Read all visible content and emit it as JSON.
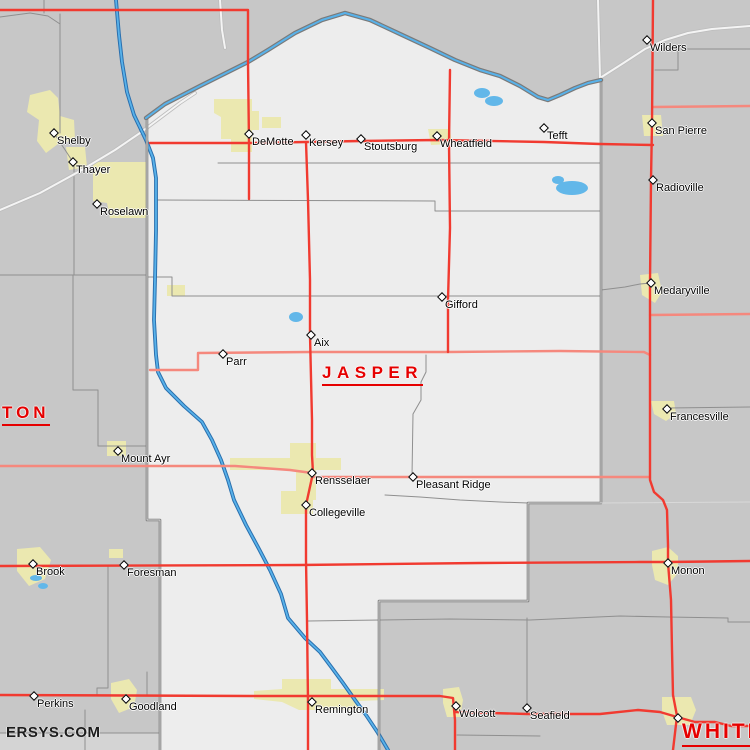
{
  "watermark": "ERSYS.COM",
  "colors": {
    "county_fill": "#ededed",
    "outside_fill": "#c7c7c7",
    "south_strip_fill": "#d4d4d4",
    "urban_fill": "#ebe8b0",
    "water": "#58b2ea",
    "water_edge": "#2a6fae",
    "major_road": "#f13a30",
    "secondary_road": "#f5887d",
    "white_road": "#f4f4f4",
    "boundary": "#787878",
    "civil_line": "#8f8f8f",
    "county_label": "#e60000",
    "town_label": "#000000"
  },
  "county_labels": [
    {
      "id": "jasper",
      "text": "JASPER",
      "x": 322,
      "y": 363,
      "font_px": 17,
      "letter_spacing_px": 5.5
    },
    {
      "id": "newton",
      "text": "TON",
      "x": 2,
      "y": 403,
      "font_px": 17,
      "letter_spacing_px": 4
    },
    {
      "id": "white",
      "text": "WHITE",
      "x": 682,
      "y": 720,
      "font_px": 21,
      "letter_spacing_px": 3
    }
  ],
  "towns": [
    {
      "name": "Shelby",
      "x": 54,
      "y": 133
    },
    {
      "name": "Thayer",
      "x": 73,
      "y": 162
    },
    {
      "name": "Roselawn",
      "x": 97,
      "y": 204
    },
    {
      "name": "DeMotte",
      "x": 249,
      "y": 134
    },
    {
      "name": "Kersey",
      "x": 306,
      "y": 135
    },
    {
      "name": "Stoutsburg",
      "x": 361,
      "y": 139
    },
    {
      "name": "Wheatfield",
      "x": 437,
      "y": 136
    },
    {
      "name": "Tefft",
      "x": 544,
      "y": 128
    },
    {
      "name": "Wilders",
      "x": 647,
      "y": 40
    },
    {
      "name": "San Pierre",
      "x": 652,
      "y": 123
    },
    {
      "name": "Radioville",
      "x": 653,
      "y": 180
    },
    {
      "name": "Medaryville",
      "x": 651,
      "y": 283
    },
    {
      "name": "Francesville",
      "x": 667,
      "y": 409
    },
    {
      "name": "Gifford",
      "x": 442,
      "y": 297
    },
    {
      "name": "Aix",
      "x": 311,
      "y": 335
    },
    {
      "name": "Parr",
      "x": 223,
      "y": 354
    },
    {
      "name": "Mount Ayr",
      "x": 118,
      "y": 451
    },
    {
      "name": "Rensselaer",
      "x": 312,
      "y": 473
    },
    {
      "name": "Pleasant Ridge",
      "x": 413,
      "y": 477
    },
    {
      "name": "Collegeville",
      "x": 306,
      "y": 505
    },
    {
      "name": "Brook",
      "x": 33,
      "y": 564
    },
    {
      "name": "Foresman",
      "x": 124,
      "y": 565
    },
    {
      "name": "Perkins",
      "x": 34,
      "y": 696
    },
    {
      "name": "Goodland",
      "x": 126,
      "y": 699
    },
    {
      "name": "Remington",
      "x": 312,
      "y": 702
    },
    {
      "name": "Wolcott",
      "x": 456,
      "y": 706
    },
    {
      "name": "Seafield",
      "x": 527,
      "y": 708
    },
    {
      "name": "Monon",
      "x": 668,
      "y": 563
    },
    {
      "name": "",
      "x": 678,
      "y": 718
    }
  ],
  "map": {
    "layers": [
      {
        "name": "south-county-region",
        "type": "fill",
        "color": "#d4d4d4",
        "paths": [
          "M0,733 L160,733 L160,750 L0,750 Z"
        ]
      },
      {
        "name": "jasper-county-region",
        "type": "fill",
        "color": "#ededed",
        "paths": [
          "M146,118 L165,104 L200,86 L232,70 L248,62 L268,50 L295,33 L322,20 L345,13 L370,20 L400,34 L430,48 L455,60 L480,70 L500,76 L520,86 L538,97 L548,100 L560,95 L575,88 L588,83 L601,80 L601,503 L528,503 L528,601 L379,601 L379,750 L160,750 L160,520 L147,520 Z"
        ]
      },
      {
        "name": "urban-areas",
        "type": "fill",
        "color": "#ebe8b0",
        "paths": [
          "M30,95 L50,90 L58,98 L60,116 L74,120 L75,140 L58,144 L46,153 L37,141 L39,120 L27,112 Z",
          "M66,147 L85,147 L87,167 L69,170 Z",
          "M93,162 L148,162 L148,218 L110,218 L107,203 L93,201 Z",
          "M214,99 L252,99 L252,111 L259,111 L259,130 L252,130 L252,152 L231,152 L231,139 L221,139 L221,117 L214,113 Z",
          "M262,117 L281,117 L281,128 L262,128 Z",
          "M428,129 L450,129 L452,144 L431,145 Z",
          "M642,115 L661,115 L663,136 L644,136 Z",
          "M640,275 L658,273 L662,292 L655,303 L642,295 Z",
          "M651,401 L674,401 L676,414 L666,421 L654,414 Z",
          "M107,441 L126,441 L126,456 L107,456 Z",
          "M230,458 L290,458 L290,443 L316,443 L316,458 L341,458 L341,470 L316,470 L316,500 L313,500 L313,514 L281,514 L281,491 L296,491 L296,470 L230,470 Z",
          "M17,549 L40,547 L51,560 L45,579 L29,586 L17,571 Z",
          "M109,549 L123,549 L123,558 L109,558 Z",
          "M111,683 L129,679 L137,690 L134,707 L119,713 L111,699 Z",
          "M254,691 L282,689 L282,679 L331,679 L331,689 L384,689 L384,700 L359,701 L359,710 L299,710 L282,702 L254,699 Z",
          "M443,689 L459,687 L463,700 L460,717 L447,717 L443,703 Z",
          "M652,551 L668,547 L678,556 L678,573 L668,585 L655,580 L652,565 Z",
          "M662,697 L691,697 L696,710 L690,725 L667,725 L662,711 Z",
          "M167,285 L185,285 L185,296 L167,296 Z"
        ]
      },
      {
        "name": "lakes",
        "type": "fill",
        "color": "#62b7e9",
        "paths": [
          "M556,188 a16,7 0 1 0 32,0 a16,7 0 1 0 -32,0 Z",
          "M552,180 a6,4 0 1 0 12,0 a6,4 0 1 0 -12,0 Z",
          "M474,93 a8,5 0 1 0 16,0 a8,5 0 1 0 -16,0 Z",
          "M485,101 a9,5 0 1 0 18,0 a9,5 0 1 0 -18,0 Z",
          "M289,317 a7,5 0 1 0 14,0 a7,5 0 1 0 -14,0 Z",
          "M30,578 a6,3 0 1 0 12,0 a6,3 0 1 0 -12,0 Z",
          "M38,586 a5,3 0 1 0 10,0 a5,3 0 1 0 -10,0 Z"
        ]
      },
      {
        "name": "civil-township-lines",
        "type": "stroke",
        "color": "#8f8f8f",
        "width": 1,
        "paths": [
          "M218,163 L601,163",
          "M156,200 L435,201 L435,211 L601,211",
          "M148,277 L172,277 L172,296 L601,296",
          "M0,275 L147,275",
          "M426,355 L426,372 L421,382 L421,400 L413,414 L412,476",
          "M385,495 L420,497 L460,500 L500,502 L528,503",
          "M308,621 L380,620 L450,619 L530,620 L575,618 L620,616 L668,617 L728,618 L728,622 L750,622",
          "M527,618 L527,706",
          "M108,566 L108,688 L97,688 L97,695",
          "M147,672 L147,695",
          "M85,710 L85,750",
          "M60,14 L60,133",
          "M0,17 L30,13 L48,16 L60,24",
          "M44,0 L44,13",
          "M54,133 L73,162",
          "M74,165 L74,275",
          "M73,275 L73,390 L98,390 L98,446 L147,446",
          "M601,290 L625,287 L640,284 L651,283",
          "M668,408 L750,407",
          "M655,49 L750,49",
          "M678,49 L678,70 L655,70",
          "M457,735 L540,736",
          "M0,733 L160,733"
        ]
      },
      {
        "name": "white-road-casing",
        "type": "stroke",
        "color": "#bcbcbc",
        "width": 3.6,
        "paths": [
          "M0,210 L40,193 L80,171 L115,150 L140,133 L160,118 L180,103 L195,93",
          "M598,0 L599,40 L600,78",
          "M600,78 L622,64 L645,49 L665,40 L688,33 L712,29 L750,26",
          "M220,0 L222,30 L225,48"
        ]
      },
      {
        "name": "white-road-core",
        "type": "stroke",
        "color": "#f4f4f4",
        "width": 2,
        "paths": [
          "M0,210 L40,193 L80,171 L115,150 L140,133 L160,118 L180,103 L195,93",
          "M598,0 L599,40 L600,78",
          "M600,78 L622,64 L645,49 L665,40 L688,33 L712,29 L750,26",
          "M220,0 L222,30 L225,48"
        ]
      },
      {
        "name": "river-casing",
        "type": "stroke",
        "color": "#2a6fae",
        "width": 3.8,
        "paths": [
          "M116,0 L119,35 L122,62 L127,92 L134,115 L146,140 L153,158 L156,178 L156,230 L155,280 L154,320 L156,355 L158,372 L166,388 L184,406 L202,422 L212,440 L221,460 L228,480 L234,500 L246,525 L259,549 L270,570 L281,594 L288,618 L305,638 L320,652 L332,668 L343,683 L355,700 L366,715 L378,733 L388,750"
        ]
      },
      {
        "name": "river-core",
        "type": "stroke",
        "color": "#58b2ea",
        "width": 1.8,
        "paths": [
          "M116,0 L119,35 L122,62 L127,92 L134,115 L146,140 L153,158 L156,178 L156,230 L155,280 L154,320 L156,355 L158,372 L166,388 L184,406 L202,422 L212,440 L221,460 L228,480 L234,500 L246,525 L259,549 L270,570 L281,594 L288,618 L305,638 L320,652 L332,668 L343,683 L355,700 L366,715 L378,733 L388,750"
        ]
      },
      {
        "name": "county-boundary",
        "type": "stroke",
        "color": "#787878",
        "width": 2.6,
        "paths": [
          "M147,118 L147,520 L160,520 L160,750",
          "M601,80 L601,503 L528,503 L528,601 L379,601 L379,750"
        ]
      },
      {
        "name": "county-boundary-core",
        "type": "stroke",
        "color": "#dcdcdc",
        "width": 0.9,
        "paths": [
          "M147,118 L147,520 L160,520 L160,750",
          "M601,80 L601,503 L528,503 L528,601 L379,601 L379,750"
        ]
      },
      {
        "name": "river-boundary-casing",
        "type": "stroke",
        "color": "#7a7a7a",
        "width": 4.4,
        "paths": [
          "M146,118 L165,104 L200,86 L232,70 L248,62 L268,50 L295,33 L322,20 L345,13 L370,20 L400,34 L430,48 L455,60 L480,70 L500,76 L520,86 L538,97 L548,100 L560,95 L575,88 L588,83 L601,80"
        ]
      },
      {
        "name": "river-boundary-core",
        "type": "stroke",
        "color": "#58b2ea",
        "width": 2,
        "paths": [
          "M146,118 L165,104 L200,86 L232,70 L248,62 L268,50 L295,33 L322,20 L345,13 L370,20 L400,34 L430,48 L455,60 L480,70 L500,76 L520,86 L538,97 L548,100 L560,95 L575,88 L588,83 L601,80"
        ]
      },
      {
        "name": "faint-county-line",
        "type": "stroke",
        "color": "#d9d9d9",
        "width": 1,
        "paths": [
          "M601,503 L750,502"
        ]
      },
      {
        "name": "secondary-roads",
        "type": "stroke",
        "color": "#f5887d",
        "width": 2.4,
        "paths": [
          "M150,370 L198,370 L198,353 L310,352 L448,352 L560,351 L644,352 L650,355",
          "M0,466 L235,466 L290,470 L312,473",
          "M313,477 L450,477 L601,477 L650,477",
          "M650,315 L750,314",
          "M653,107 L750,106"
        ]
      },
      {
        "name": "major-roads",
        "type": "stroke",
        "color": "#f13a30",
        "width": 2.4,
        "paths": [
          "M0,10 L248,10 L248,63 L249,143 L249,199",
          "M653,0 L652,123 L651,180 L650,283 L650,352 L650,445 L650,480 L654,492 L663,500 L667,510 L668,545 L668,563 L671,600 L672,650 L673,695 L677,716",
          "M677,716 L673,750",
          "M0,566 L300,565 L480,563 L640,562 L668,562 L750,561",
          "M306,142 L308,200 L310,280 L310,335 L312,420 L312,455 L313,473 L306,505 L306,560 L307,620 L308,702 L308,750",
          "M0,695 L250,696 L440,696 L453,698 L455,720 L455,750",
          "M455,712 L527,714 L600,714 L638,710 L660,712 L677,717 L695,722 L715,722 L731,726 L750,726",
          "M450,70 L449,143 L450,228 L448,300 L448,352",
          "M150,143 L249,143 L306,142 L361,141 L437,140 L544,142 L600,144 L653,145"
        ]
      }
    ]
  }
}
